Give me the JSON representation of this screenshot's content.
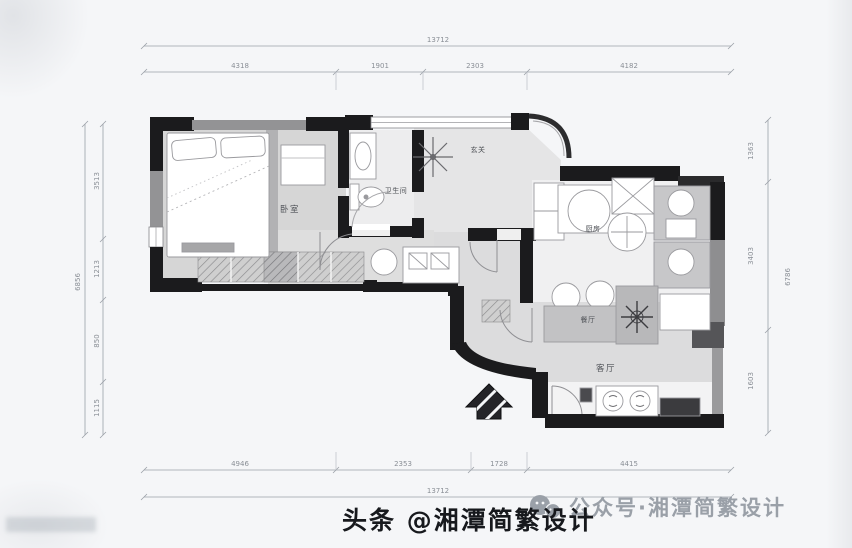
{
  "page": {
    "background": "#f5f6f8"
  },
  "plan": {
    "rooms": [
      {
        "id": "bedroom",
        "label": "卧室"
      },
      {
        "id": "bathroom",
        "label": "卫生间"
      },
      {
        "id": "foyer",
        "label": "玄关"
      },
      {
        "id": "kitchen",
        "label": "厨房"
      },
      {
        "id": "dining",
        "label": "餐厅"
      },
      {
        "id": "living",
        "label": "客厅"
      }
    ],
    "entry_arrow_icon": "entry-arrow-icon",
    "wall_color": "#1b1b1d",
    "floor_color": "#d7d7d7"
  },
  "dims": {
    "top": {
      "total": "13712",
      "segments": [
        "4318",
        "1901",
        "2303",
        "4182"
      ]
    },
    "bottom": {
      "total": "13712",
      "segments": [
        "4946",
        "2353",
        "1728",
        "4415"
      ]
    },
    "left": {
      "total": "6856",
      "segments": [
        "3513",
        "1213",
        "850",
        "1115"
      ]
    },
    "right": {
      "total": "6786",
      "segments": [
        "1363",
        "3403",
        "1603"
      ]
    }
  },
  "watermarks": {
    "wechat": {
      "icon": "wechat-icon",
      "label": "公众号·湘潭简繁设计",
      "color": "#9aa0a8"
    },
    "toutiao": {
      "label": "头条 @湘潭简繁设计",
      "color": "#17191d"
    }
  }
}
